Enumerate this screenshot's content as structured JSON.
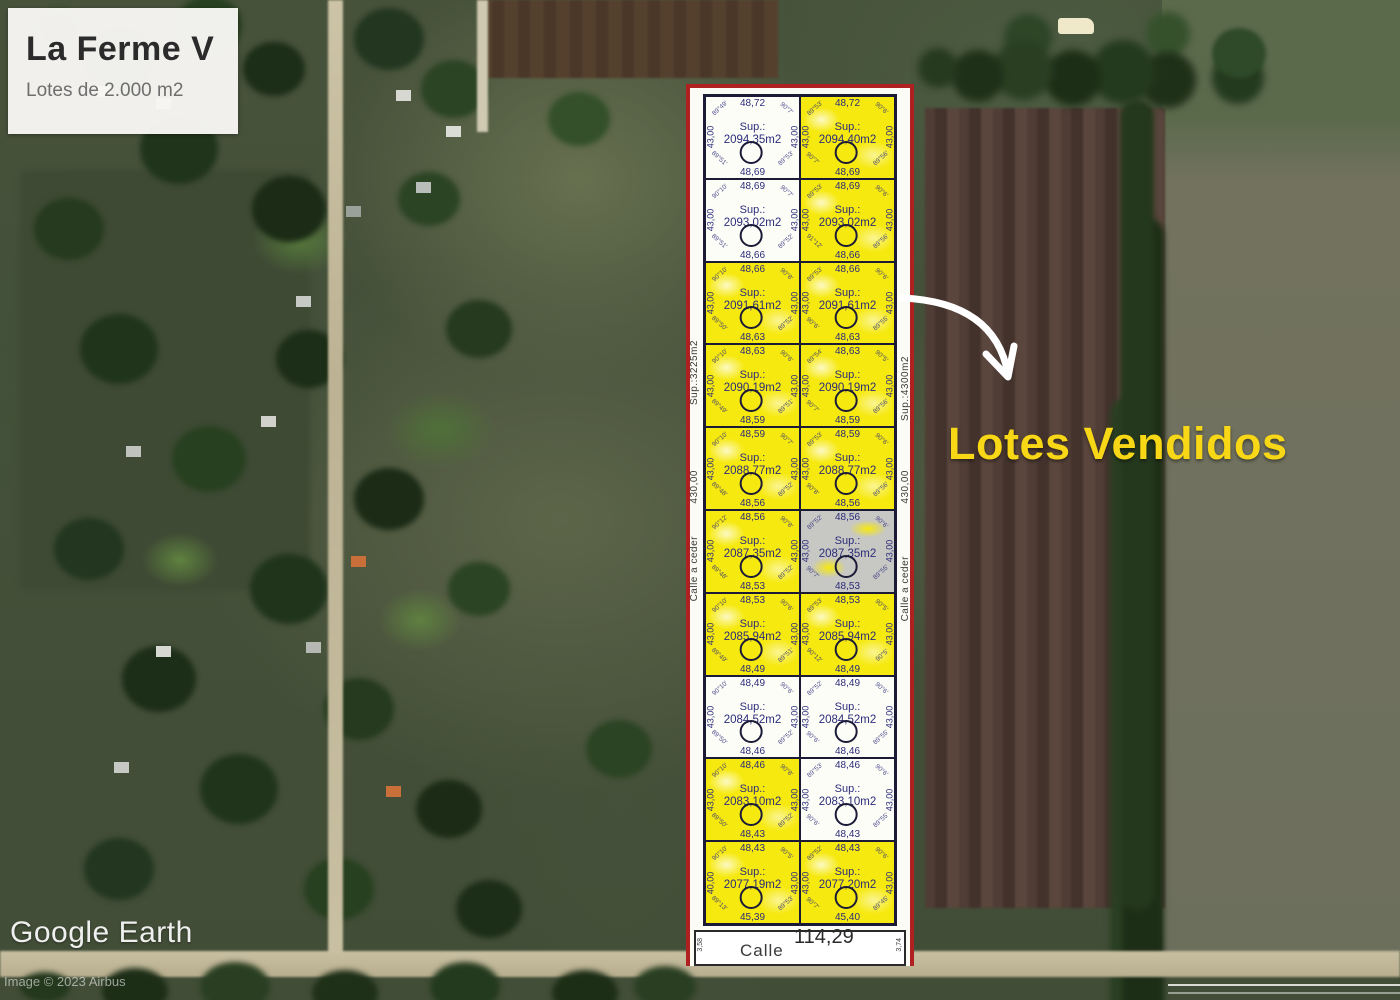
{
  "title_card": {
    "title": "La Ferme V",
    "subtitle": "Lotes de 2.000 m2"
  },
  "overlay": {
    "sold_label": "Lotes Vendidos",
    "sold_label_color": "#f7d716",
    "arrow_color": "#ffffff"
  },
  "watermark": {
    "logo": "Google Earth",
    "credit": "Image © 2023 Airbus"
  },
  "plot": {
    "border_color": "#b02020",
    "line_color": "#1b1b38",
    "ink_color": "#2c2c7a",
    "fill_sold": "#f6e90f",
    "fill_available": "#fdfdf8",
    "fill_reserved": "#c7c7c3",
    "sup_label": "Sup.:",
    "left_margin_labels": [
      "Sup.:3225m2",
      "430,00",
      "Calle a ceder"
    ],
    "right_margin_labels": [
      "Sup.:4300m2",
      "430,00",
      "Calle a ceder"
    ],
    "street": {
      "name": "Calle",
      "width_label": "114,29",
      "tick_left": "3,58",
      "tick_right": "3,74"
    },
    "lots": [
      {
        "row": 1,
        "col": "left",
        "status": "available",
        "top": "48,72",
        "sup": "2094,35m2",
        "bottom": "48,69",
        "left": "43,00",
        "right": "43,00",
        "angles": {
          "tl": "89°49'",
          "tr": "90°7'",
          "bl": "89°51'",
          "br": "89°53'"
        }
      },
      {
        "row": 1,
        "col": "right",
        "status": "sold",
        "top": "48,72",
        "sup": "2094,40m2",
        "bottom": "48,69",
        "left": "43,00",
        "right": "43,00",
        "angles": {
          "tl": "89°53'",
          "tr": "90°6'",
          "bl": "90°7'",
          "br": "89°56'"
        }
      },
      {
        "row": 2,
        "col": "left",
        "status": "available",
        "top": "48,69",
        "sup": "2093,02m2",
        "bottom": "48,66",
        "left": "43,00",
        "right": "43,00",
        "angles": {
          "tl": "90°10'",
          "tr": "90°7'",
          "bl": "89°51'",
          "br": "89°52'"
        }
      },
      {
        "row": 2,
        "col": "right",
        "status": "sold",
        "top": "48,69",
        "sup": "2093,02m2",
        "bottom": "48,66",
        "left": "43,00",
        "right": "43,00",
        "angles": {
          "tl": "89°53'",
          "tr": "90°6'",
          "bl": "91°12'",
          "br": "89°56'"
        }
      },
      {
        "row": 3,
        "col": "left",
        "status": "sold",
        "top": "48,66",
        "sup": "2091,61m2",
        "bottom": "48,63",
        "left": "43,00",
        "right": "43,00",
        "angles": {
          "tl": "90°10'",
          "tr": "90°8'",
          "bl": "89°50'",
          "br": "89°52'"
        }
      },
      {
        "row": 3,
        "col": "right",
        "status": "sold",
        "top": "48,66",
        "sup": "2091,61m2",
        "bottom": "48,63",
        "left": "43,00",
        "right": "43,00",
        "angles": {
          "tl": "89°53'",
          "tr": "90°6'",
          "bl": "90°6'",
          "br": "89°55'"
        }
      },
      {
        "row": 4,
        "col": "left",
        "status": "sold",
        "top": "48,63",
        "sup": "2090,19m2",
        "bottom": "48,59",
        "left": "43,00",
        "right": "43,00",
        "angles": {
          "tl": "90°10'",
          "tr": "90°6'",
          "bl": "89°49'",
          "br": "89°51'"
        }
      },
      {
        "row": 4,
        "col": "right",
        "status": "sold",
        "top": "48,63",
        "sup": "2090,19m2",
        "bottom": "48,59",
        "left": "43,00",
        "right": "43,00",
        "angles": {
          "tl": "89°54'",
          "tr": "90°5'",
          "bl": "90°7'",
          "br": "89°56'"
        }
      },
      {
        "row": 5,
        "col": "left",
        "status": "sold",
        "top": "48,59",
        "sup": "2088,77m2",
        "bottom": "48,56",
        "left": "43,00",
        "right": "43,00",
        "angles": {
          "tl": "90°10'",
          "tr": "90°7'",
          "bl": "89°48'",
          "br": "89°52'"
        }
      },
      {
        "row": 5,
        "col": "right",
        "status": "sold",
        "top": "48,59",
        "sup": "2088,77m2",
        "bottom": "48,56",
        "left": "43,00",
        "right": "43,00",
        "angles": {
          "tl": "89°53'",
          "tr": "90°6'",
          "bl": "90°8'",
          "br": "89°56'"
        }
      },
      {
        "row": 6,
        "col": "left",
        "status": "sold",
        "top": "48,56",
        "sup": "2087,35m2",
        "bottom": "48,53",
        "left": "43,00",
        "right": "43,00",
        "angles": {
          "tl": "90°12'",
          "tr": "90°8'",
          "bl": "89°48'",
          "br": "89°52'"
        }
      },
      {
        "row": 6,
        "col": "right",
        "status": "reserved",
        "top": "48,56",
        "sup": "2087,35m2",
        "bottom": "48,53",
        "left": "43,00",
        "right": "43,00",
        "angles": {
          "tl": "89°52'",
          "tr": "90°6'",
          "bl": "90°7'",
          "br": "89°55'"
        }
      },
      {
        "row": 7,
        "col": "left",
        "status": "sold",
        "top": "48,53",
        "sup": "2085,94m2",
        "bottom": "48,49",
        "left": "43,00",
        "right": "43,00",
        "angles": {
          "tl": "90°10'",
          "tr": "90°6'",
          "bl": "89°49'",
          "br": "89°51'"
        }
      },
      {
        "row": 7,
        "col": "right",
        "status": "sold",
        "top": "48,53",
        "sup": "2085,94m2",
        "bottom": "48,49",
        "left": "43,00",
        "right": "43,00",
        "angles": {
          "tl": "89°53'",
          "tr": "90°5'",
          "bl": "90°12'",
          "br": "90°5'"
        }
      },
      {
        "row": 8,
        "col": "left",
        "status": "available",
        "top": "48,49",
        "sup": "2084,52m2",
        "bottom": "48,46",
        "left": "43,00",
        "right": "43,00",
        "angles": {
          "tl": "90°10'",
          "tr": "90°6'",
          "bl": "89°50'",
          "br": "89°52'"
        }
      },
      {
        "row": 8,
        "col": "right",
        "status": "available",
        "top": "48,49",
        "sup": "2084,52m2",
        "bottom": "48,46",
        "left": "43,00",
        "right": "43,00",
        "angles": {
          "tl": "89°52'",
          "tr": "90°6'",
          "bl": "90°6'",
          "br": "89°55'"
        }
      },
      {
        "row": 9,
        "col": "left",
        "status": "sold",
        "top": "48,46",
        "sup": "2083,10m2",
        "bottom": "48,43",
        "left": "43,00",
        "right": "43,00",
        "angles": {
          "tl": "90°10'",
          "tr": "90°8'",
          "bl": "89°50'",
          "br": "89°52'"
        }
      },
      {
        "row": 9,
        "col": "right",
        "status": "available",
        "top": "48,46",
        "sup": "2083,10m2",
        "bottom": "48,43",
        "left": "43,00",
        "right": "43,00",
        "angles": {
          "tl": "89°53'",
          "tr": "90°6'",
          "bl": "90°6'",
          "br": "89°55'"
        }
      },
      {
        "row": 10,
        "col": "left",
        "status": "sold",
        "top": "48,43",
        "sup": "2077,19m2",
        "bottom": "45,39",
        "left": "40,00",
        "right": "43,00",
        "angles": {
          "tl": "90°10'",
          "tr": "90°5'",
          "bl": "89°13'",
          "br": "89°53'"
        }
      },
      {
        "row": 10,
        "col": "right",
        "status": "sold",
        "top": "48,43",
        "sup": "2077,20m2",
        "bottom": "45,40",
        "left": "43,00",
        "right": "43,00",
        "angles": {
          "tl": "89°52'",
          "tr": "90°6'",
          "bl": "90°7'",
          "br": "89°45'"
        }
      }
    ]
  }
}
